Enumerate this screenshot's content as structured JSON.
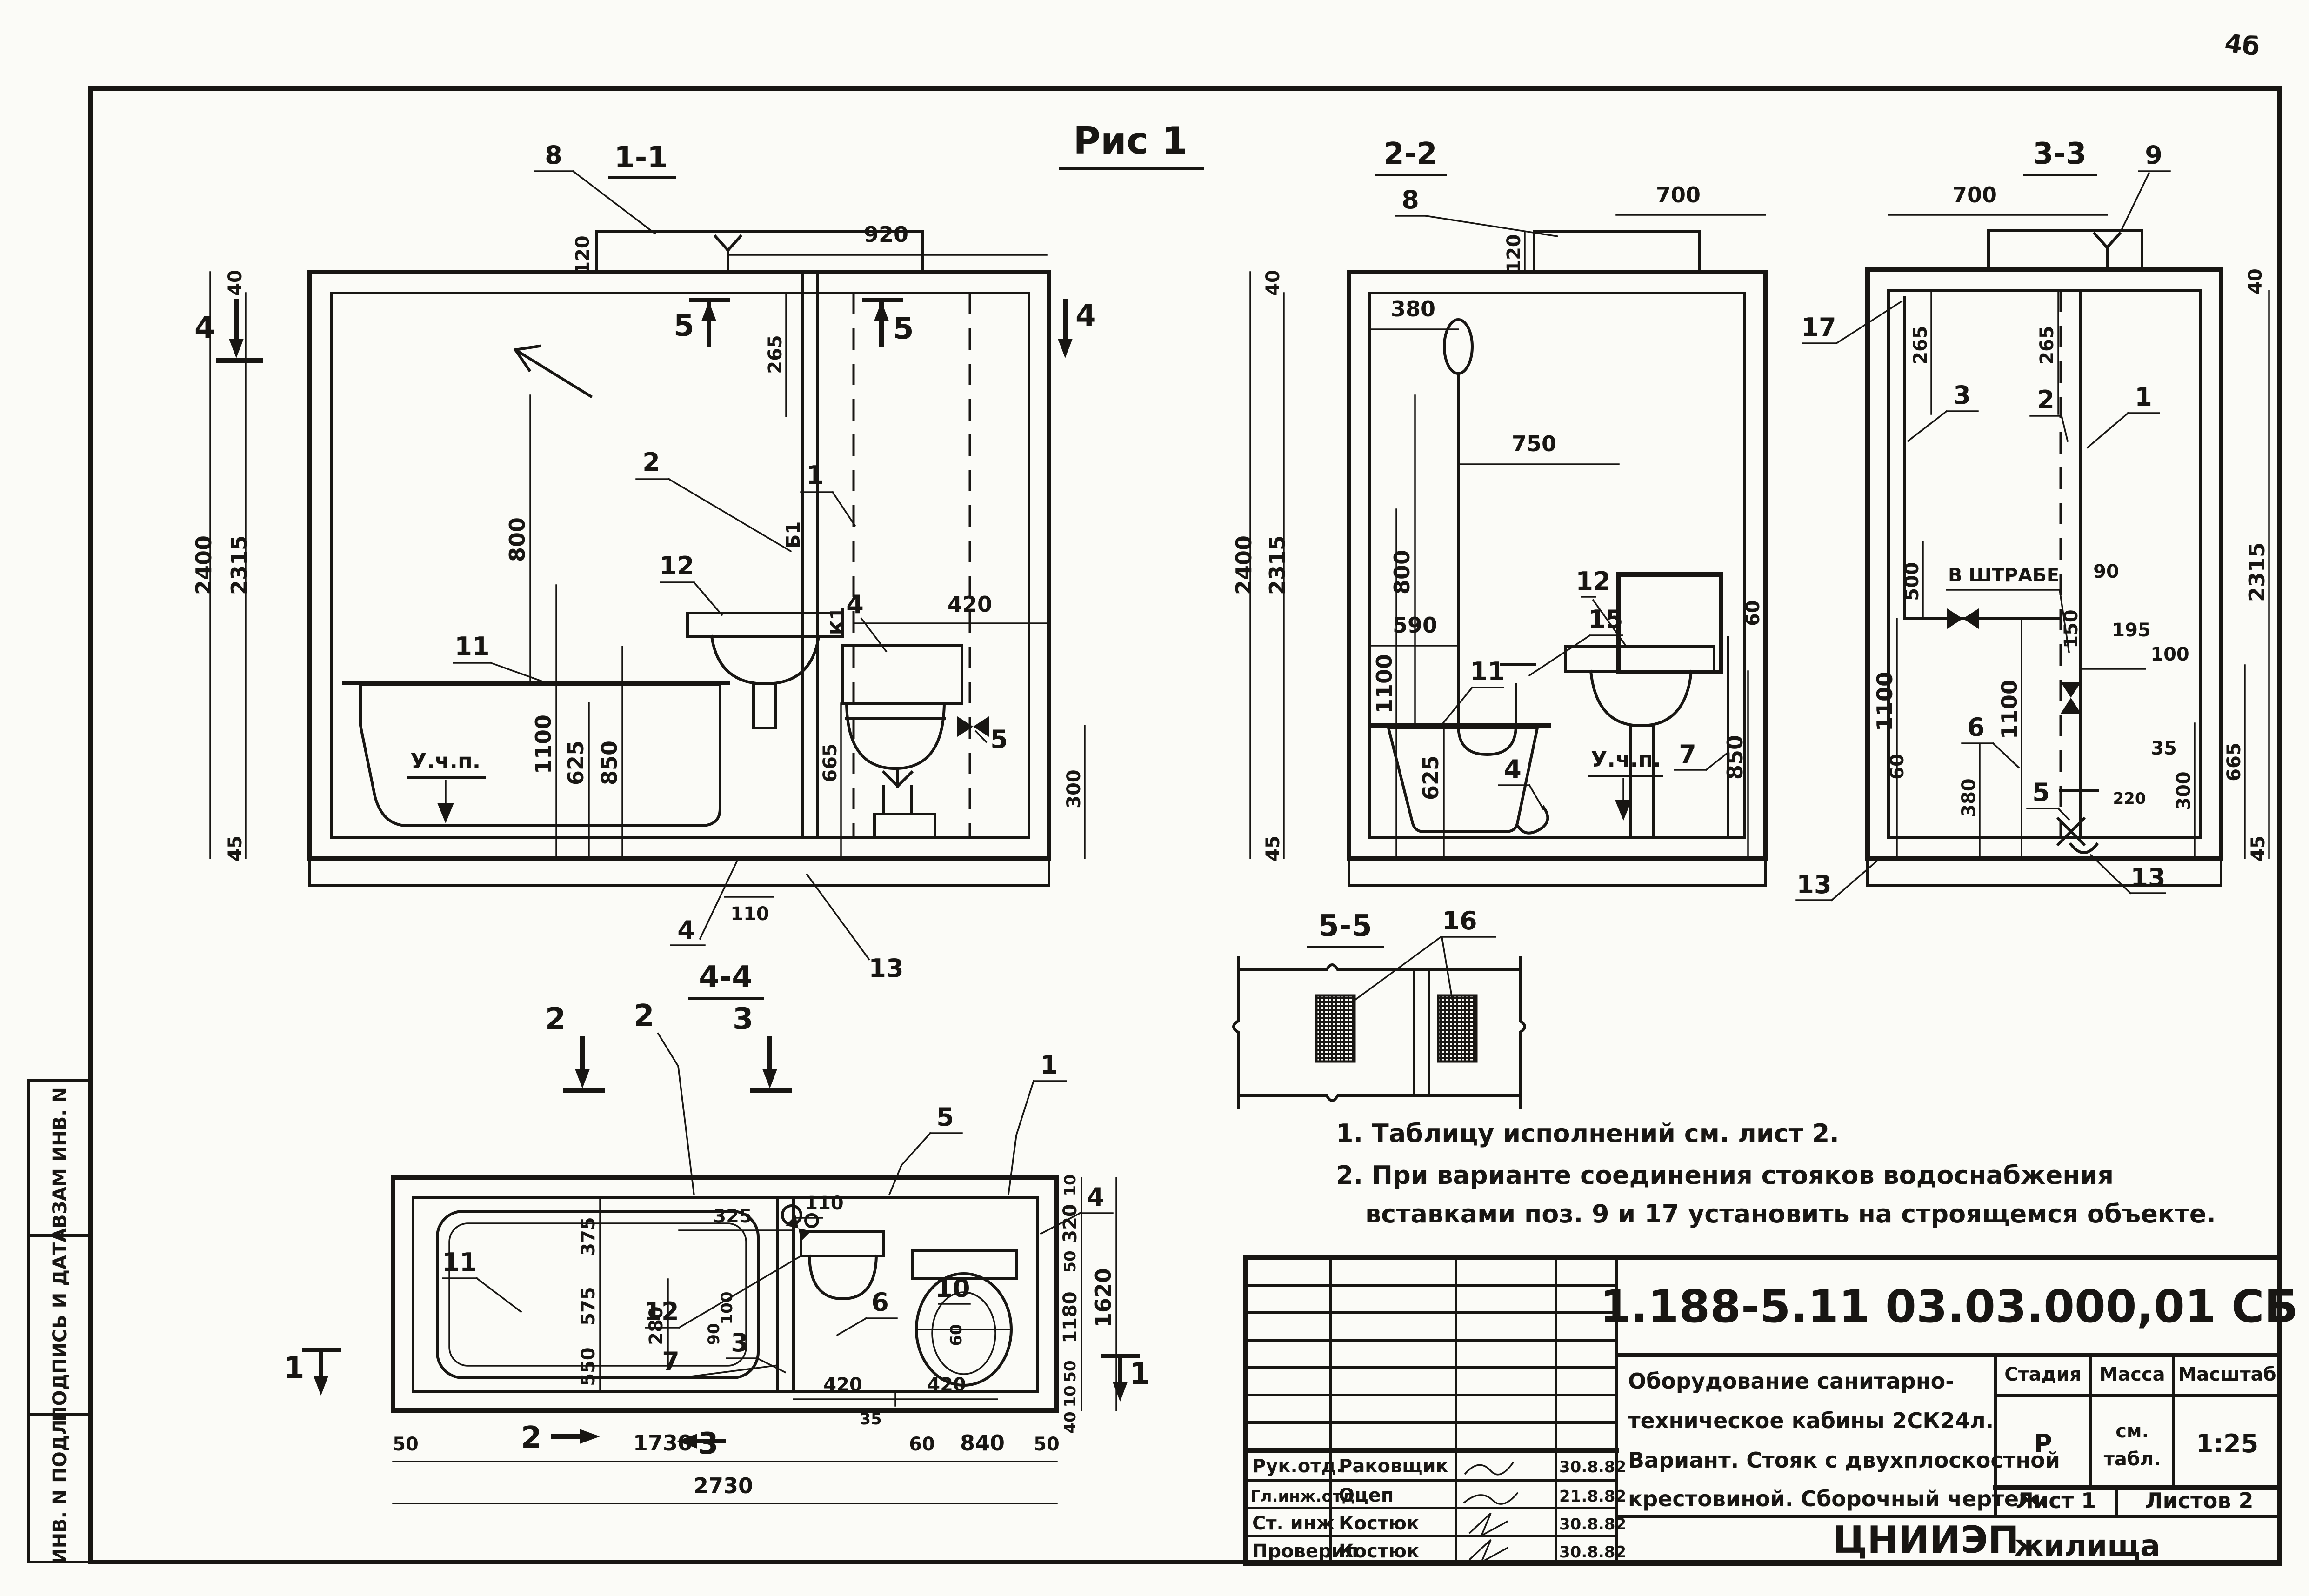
{
  "sheet": {
    "corner_mark": "4б",
    "figure_title": "Рис 1",
    "side_stamp": {
      "top": "ВЗАМ ИНВ. N",
      "middle": "ПОДПИСЬ И ДАТА",
      "bottom": "ИНВ. N ПОДЛ."
    },
    "notes": {
      "line1": "1. Таблицу исполнений см. лист 2.",
      "line2": "2. При варианте соединения стояков водоснабжения",
      "line3": "вставками поз. 9 и 17 установить на строящемся объекте."
    }
  },
  "views": {
    "v11": {
      "title": "1-1",
      "section_marks": {
        "s4_left": "4",
        "s4_right": "4",
        "s5_left": "5",
        "s5_right": "5"
      },
      "positions": {
        "p8": "8",
        "p2": "2",
        "p1": "1",
        "p12": "12",
        "p11": "11",
        "p4_cistern": "4",
        "p5_valve": "5",
        "p4_trap": "4",
        "p13": "13"
      },
      "risers": {
        "b1": "Б1",
        "k1": "К1"
      },
      "dims": {
        "d920": "920",
        "d120": "120",
        "d40": "40",
        "d2400": "2400",
        "d2315": "2315",
        "d265": "265",
        "d800": "800",
        "d1100": "1100",
        "d625": "625",
        "d850": "850",
        "d420": "420",
        "d665": "665",
        "d300": "300",
        "d110": "110",
        "d45": "45"
      },
      "floor_mark": "У.ч.п."
    },
    "v22": {
      "title": "2-2",
      "positions": {
        "p8": "8",
        "p15": "15",
        "p7": "7",
        "p12": "12",
        "p11": "11",
        "p4": "4"
      },
      "dims": {
        "d40": "40",
        "d2400": "2400",
        "d2315": "2315",
        "d120": "120",
        "d700": "700",
        "d380": "380",
        "d750": "750",
        "d800": "800",
        "d590": "590",
        "d1100": "1100",
        "d625": "625",
        "d850": "850",
        "d60": "60",
        "d45": "45"
      },
      "floor_mark": "У.ч.п."
    },
    "v33": {
      "title": "3-3",
      "positions": {
        "p9": "9",
        "p17": "17",
        "p3": "3",
        "p2": "2",
        "p1": "1",
        "p6": "6",
        "p5": "5",
        "p13_left": "13",
        "p13_right": "13"
      },
      "dims": {
        "d700": "700",
        "d40": "40",
        "d265_left": "265",
        "d265_right": "265",
        "d500": "500",
        "d90": "90",
        "d150": "150",
        "d195": "195",
        "d1100_left": "1100",
        "d1100_right": "1100",
        "d60": "60",
        "d380": "380",
        "d35": "35",
        "d100": "100",
        "d300": "300",
        "d665": "665",
        "d220": "220",
        "d2315": "2315",
        "d45": "45"
      },
      "note_shtrabe": "В ШТРАБЕ"
    },
    "v44": {
      "title": "4-4",
      "section_marks": {
        "top2a": "2",
        "top2b": "2",
        "top3": "3",
        "bottom2": "2",
        "bottom3": "3",
        "left1": "1",
        "right1": "1"
      },
      "positions": {
        "p11": "11",
        "p12": "12",
        "p7": "7",
        "p3": "3",
        "p6": "6",
        "p10": "10",
        "p5": "5",
        "p1": "1",
        "p4": "4"
      },
      "dims": {
        "d110": "110",
        "d325": "325",
        "d375": "375",
        "d280": "280",
        "d90": "90",
        "d100": "100",
        "d575": "575",
        "d550": "550",
        "d420a": "420",
        "d420b": "420",
        "d35": "35",
        "d60": "60",
        "d50a": "50",
        "d1730": "1730",
        "d60b": "60",
        "d840": "840",
        "d50b": "50",
        "d2730": "2730",
        "d10a": "10",
        "d320": "320",
        "d50c": "50",
        "d1180": "1180",
        "d50d": "50",
        "d10b": "10",
        "d1620": "1620",
        "d40": "40"
      }
    },
    "v55": {
      "title": "5-5",
      "positions": {
        "p16": "16"
      }
    }
  },
  "title_block": {
    "doc_number": "1.188-5.11   03.03.000,01 СБ",
    "description": {
      "line1": "Оборудование санитарно-",
      "line2": "техническое кабины 2СК24л.",
      "line3": "Вариант. Стояк с двухплоскостной",
      "line4": "крестовиной. Сборочный чертеж."
    },
    "stage_header": "Стадия",
    "mass_header": "Масса",
    "scale_header": "Масштаб",
    "stage_value": "Р",
    "mass_value_line1": "см.",
    "mass_value_line2": "табл.",
    "scale_value": "1:25",
    "sheet_label": "Лист 1",
    "sheets_label": "Листов 2",
    "org_line1": "ЦНИИЭП",
    "org_line2": "жилища",
    "sign_rows": [
      {
        "role": "Рук.отд.",
        "name": "Раковщик",
        "date": "30.8.82"
      },
      {
        "role": "Гл.инж.отд",
        "name": "Оцеп",
        "date": "21.8.82"
      },
      {
        "role": "Ст. инж",
        "name": "Костюк",
        "date": "30.8.82"
      },
      {
        "role": "Проверил",
        "name": "Костюк",
        "date": "30.8.82"
      }
    ]
  },
  "colors": {
    "ink": "#181613",
    "paper": "#fbfbf7"
  }
}
